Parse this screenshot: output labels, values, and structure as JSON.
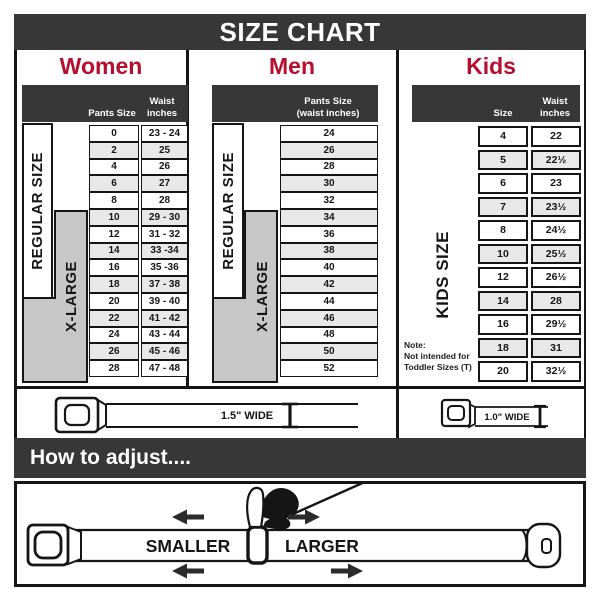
{
  "title": "SIZE CHART",
  "sections": {
    "women": {
      "heading": "Women",
      "header": {
        "col_pants": "Pants Size",
        "col_waist_1": "Waist",
        "col_waist_2": "inches"
      },
      "labels": {
        "regular": "REGULAR SIZE",
        "xlarge": "X-LARGE"
      },
      "rows": [
        {
          "size": "0",
          "waist": "23 - 24"
        },
        {
          "size": "2",
          "waist": "25"
        },
        {
          "size": "4",
          "waist": "26"
        },
        {
          "size": "6",
          "waist": "27"
        },
        {
          "size": "8",
          "waist": "28"
        },
        {
          "size": "10",
          "waist": "29 - 30"
        },
        {
          "size": "12",
          "waist": "31 - 32"
        },
        {
          "size": "14",
          "waist": "33 -34"
        },
        {
          "size": "16",
          "waist": "35 -36"
        },
        {
          "size": "18",
          "waist": "37 - 38"
        },
        {
          "size": "20",
          "waist": "39 - 40"
        },
        {
          "size": "22",
          "waist": "41 - 42"
        },
        {
          "size": "24",
          "waist": "43 - 44"
        },
        {
          "size": "26",
          "waist": "45 - 46"
        },
        {
          "size": "28",
          "waist": "47 - 48"
        }
      ]
    },
    "men": {
      "heading": "Men",
      "header": {
        "line1": "Pants Size",
        "line2": "(waist inches)"
      },
      "labels": {
        "regular": "REGULAR SIZE",
        "xlarge": "X-LARGE"
      },
      "rows": [
        {
          "size": "24"
        },
        {
          "size": "26"
        },
        {
          "size": "28"
        },
        {
          "size": "30"
        },
        {
          "size": "32"
        },
        {
          "size": "34"
        },
        {
          "size": "36"
        },
        {
          "size": "38"
        },
        {
          "size": "40"
        },
        {
          "size": "42"
        },
        {
          "size": "44"
        },
        {
          "size": "46"
        },
        {
          "size": "48"
        },
        {
          "size": "50"
        },
        {
          "size": "52"
        }
      ]
    },
    "kids": {
      "heading": "Kids",
      "header": {
        "col_size": "Size",
        "col_waist_1": "Waist",
        "col_waist_2": "inches"
      },
      "labels": {
        "kids": "KIDS SIZE"
      },
      "note": {
        "line1": "Note:",
        "line2": "Not intended for",
        "line3": "Toddler Sizes (T)"
      },
      "rows": [
        {
          "size": "4",
          "waist": "22"
        },
        {
          "size": "5",
          "waist": "22½"
        },
        {
          "size": "6",
          "waist": "23"
        },
        {
          "size": "7",
          "waist": "23½"
        },
        {
          "size": "8",
          "waist": "24½"
        },
        {
          "size": "10",
          "waist": "25½"
        },
        {
          "size": "12",
          "waist": "26½"
        },
        {
          "size": "14",
          "waist": "28"
        },
        {
          "size": "16",
          "waist": "29½"
        },
        {
          "size": "18",
          "waist": "31"
        },
        {
          "size": "20",
          "waist": "32½"
        }
      ]
    }
  },
  "belts": {
    "adult_width_label": "1.5\" WIDE",
    "kids_width_label": "1.0\" WIDE"
  },
  "adjust": {
    "heading": "How to adjust....",
    "smaller_label": "SMALLER",
    "larger_label": "LARGER"
  },
  "colors": {
    "accent_red": "#b60e2f",
    "dark_bar": "#373737",
    "row_alt": "#e8e8e8",
    "xlarge_gray": "#c7c7c7",
    "line": "#151515"
  }
}
